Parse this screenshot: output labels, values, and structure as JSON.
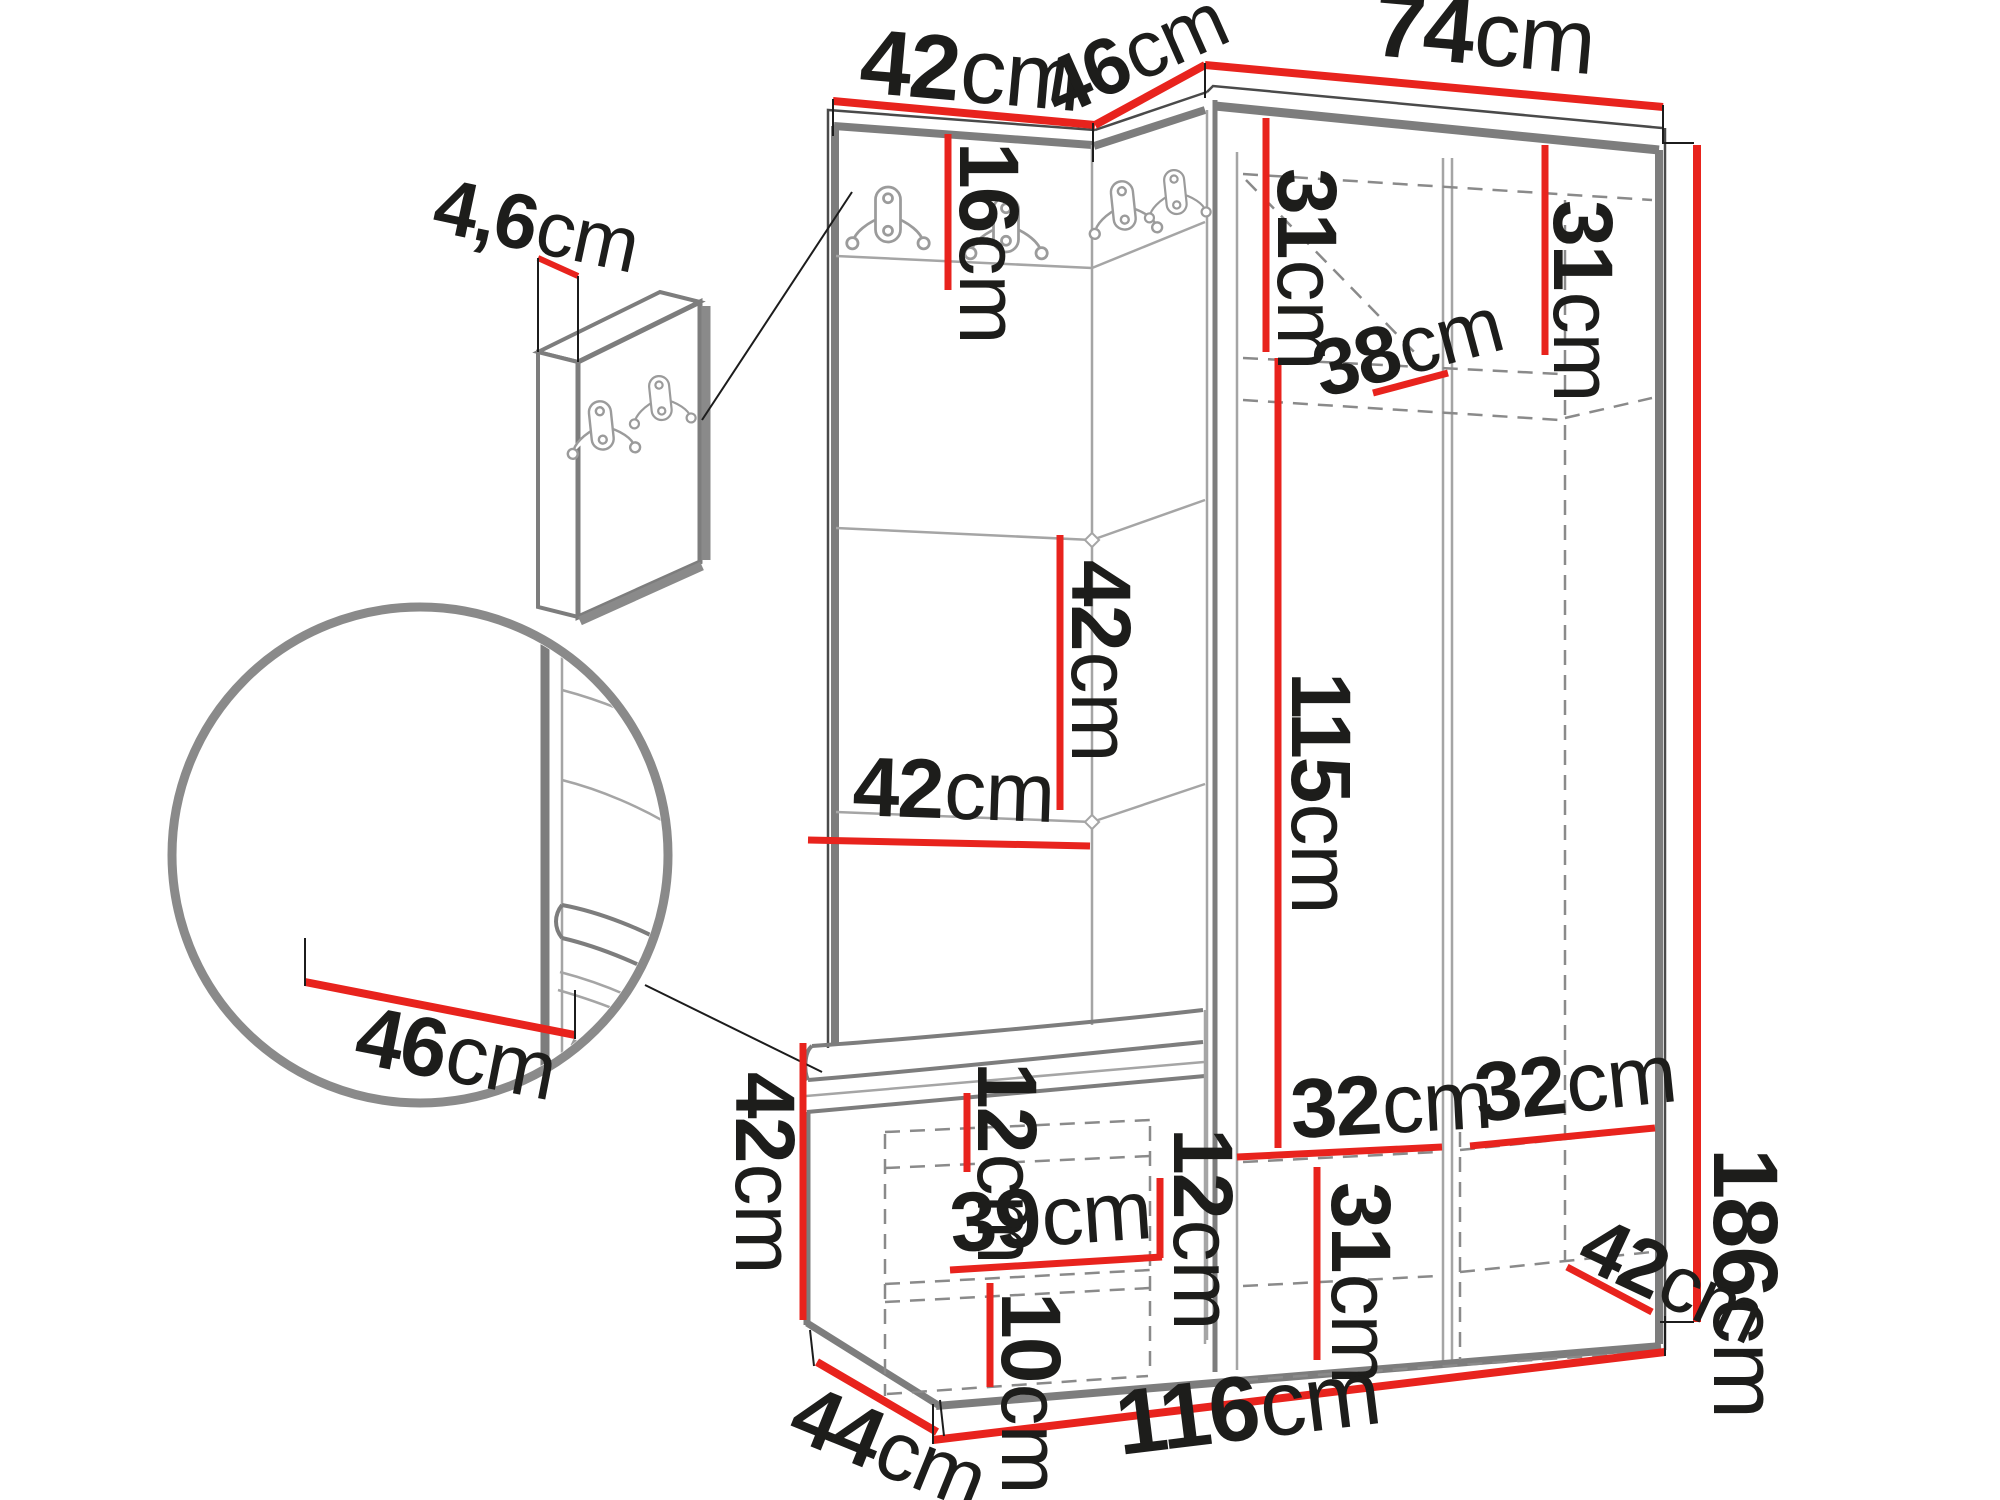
{
  "diagram": {
    "title": "hallway-furniture-dimension-diagram",
    "unit_suffix": "cm",
    "colors": {
      "dimension_red": "#e8231d",
      "outline_gray": "#7d7d7d",
      "seam_gray": "#a5a5a5",
      "label_black": "#1d1d1b",
      "background": "#ffffff"
    },
    "dimensions": {
      "top_panel_width": {
        "value": "42",
        "unit": "cm"
      },
      "corner_top_width": {
        "value": "46",
        "unit": "cm"
      },
      "wardrobe_top_width": {
        "value": "74",
        "unit": "cm"
      },
      "wall_panel_thickness": {
        "value": "4,6",
        "unit": "cm"
      },
      "hook_rail_height": {
        "value": "16",
        "unit": "cm"
      },
      "left_door_shelf_height": {
        "value": "31",
        "unit": "cm"
      },
      "right_door_shelf_height": {
        "value": "31",
        "unit": "cm"
      },
      "top_shelf_depth": {
        "value": "38",
        "unit": "cm"
      },
      "cushion_panel_height": {
        "value": "42",
        "unit": "cm"
      },
      "cushion_panel_width": {
        "value": "42",
        "unit": "cm"
      },
      "hanging_space_height": {
        "value": "115",
        "unit": "cm"
      },
      "total_height": {
        "value": "186",
        "unit": "cm"
      },
      "bench_seat_depth": {
        "value": "46",
        "unit": "cm"
      },
      "bench_height": {
        "value": "42",
        "unit": "cm"
      },
      "bench_top_inset": {
        "value": "12",
        "unit": "cm"
      },
      "bench_inner_width": {
        "value": "39",
        "unit": "cm"
      },
      "bench_shelf_gap": {
        "value": "12",
        "unit": "cm"
      },
      "bench_bottom_gap": {
        "value": "10",
        "unit": "cm"
      },
      "bench_depth": {
        "value": "44",
        "unit": "cm"
      },
      "bottom_left_shelf_width": {
        "value": "32",
        "unit": "cm"
      },
      "bottom_right_shelf_width": {
        "value": "32",
        "unit": "cm"
      },
      "bottom_shelf_height": {
        "value": "31",
        "unit": "cm"
      },
      "wardrobe_bottom_depth": {
        "value": "42",
        "unit": "cm"
      },
      "total_width": {
        "value": "116",
        "unit": "cm"
      }
    }
  }
}
